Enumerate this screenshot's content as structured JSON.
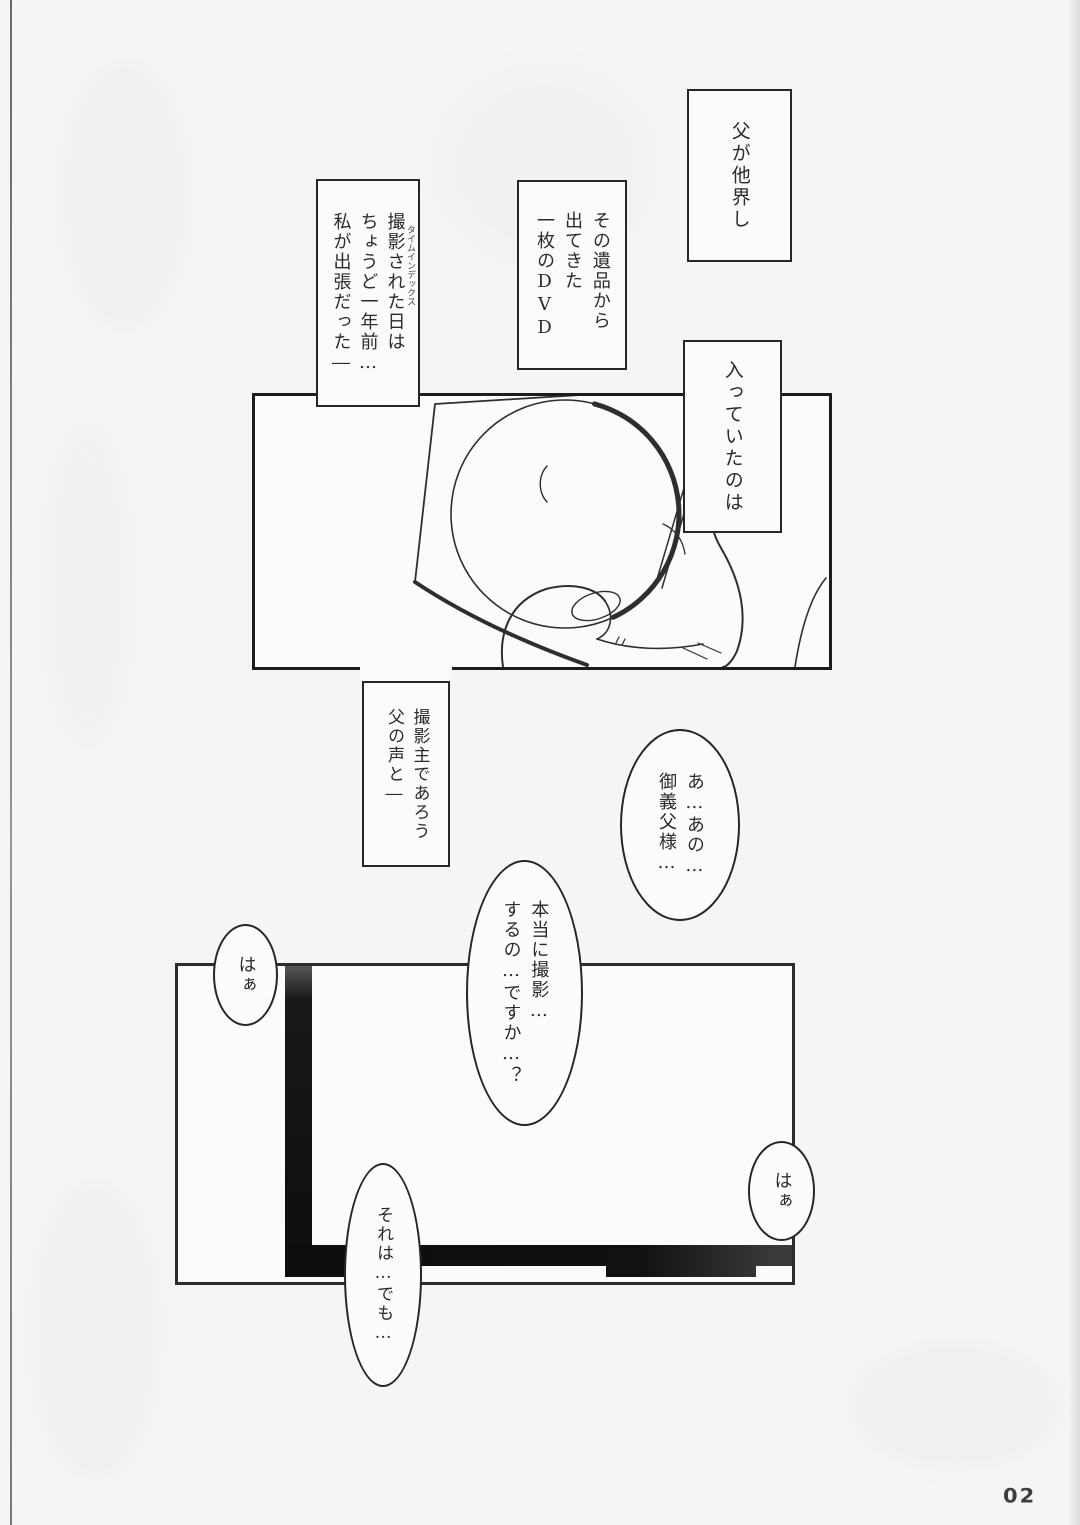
{
  "page": {
    "number_label": "02",
    "colors": {
      "paper": "#f5f5f3",
      "panel_fill": "#fbfbf9",
      "ink": "#2b2b2b",
      "panel_border": "#1c1c1c",
      "dark_bar": "#0e0e0e",
      "bubble_fill": "#fcfcfb"
    }
  },
  "captions": [
    {
      "lines": [
        "父が他界し"
      ]
    },
    {
      "lines": [
        "その遺品から",
        "出てきた",
        "一枚のDVD"
      ]
    },
    {
      "lines": [
        "撮影された日は",
        "ちょうど一年前…",
        "私が出張だった―"
      ],
      "furigana": "タイムインデックス"
    },
    {
      "lines": [
        "入っていたのは"
      ]
    },
    {
      "lines": [
        "撮影主であろう",
        "父の声と―"
      ]
    }
  ],
  "bubbles": [
    {
      "lines": [
        "あ…あの…",
        "御義父様…"
      ]
    },
    {
      "lines": [
        "本当に撮影…",
        "するの…ですか…？"
      ]
    },
    {
      "lines": [
        "はぁ"
      ]
    },
    {
      "lines": [
        "はぁ"
      ]
    },
    {
      "lines": [
        "それは…でも…"
      ]
    }
  ],
  "panels": [
    {
      "description": "Close-up sketch of a hand holding a DVD disc in a tilted square sleeve"
    },
    {
      "description": "Mostly blank room panel with dark L-shaped frame shadow along left and bottom"
    }
  ]
}
